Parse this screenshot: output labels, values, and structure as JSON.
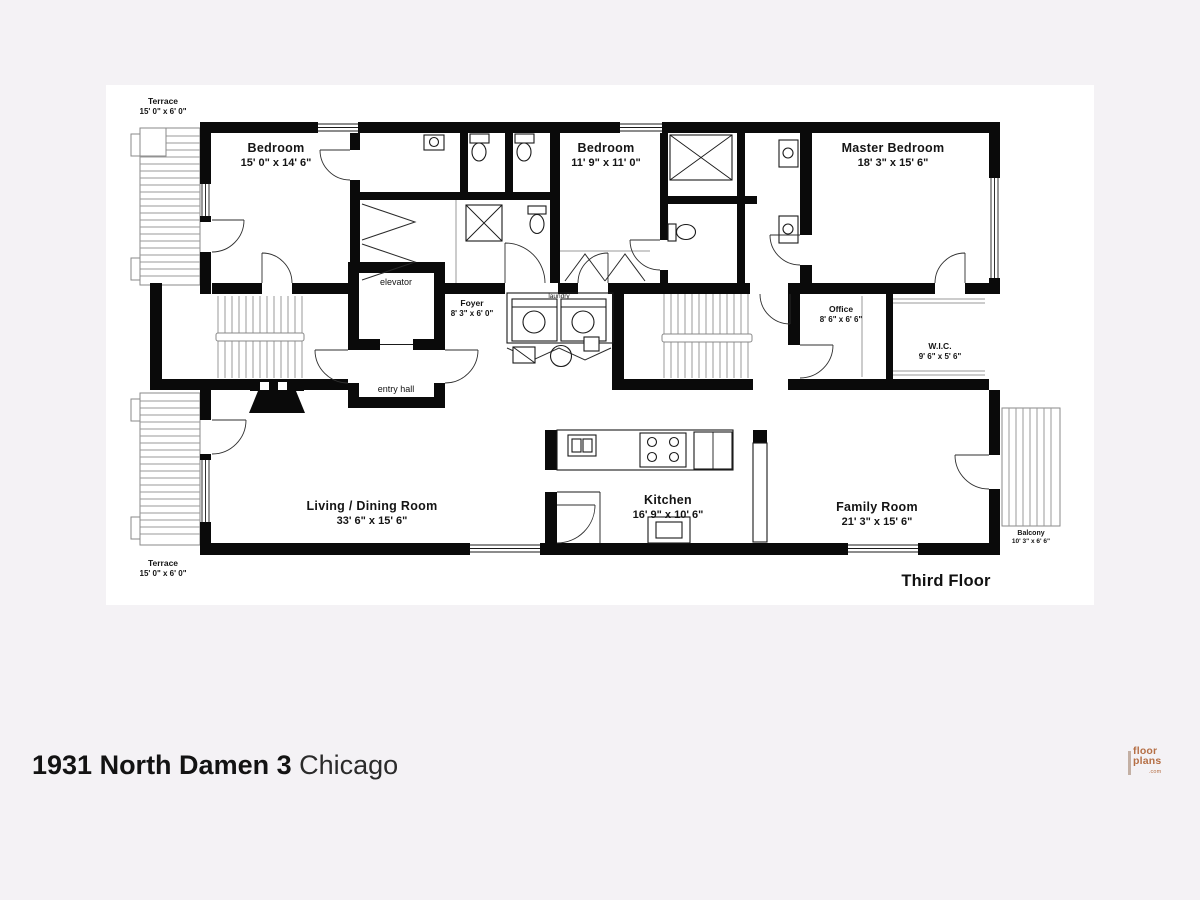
{
  "colors": {
    "wall": "#0a0a0a",
    "line-gray": "#999999",
    "bg": "#f4f2f5",
    "sheet": "#ffffff",
    "logo-orange": "#b56f45",
    "text": "#1b1b1b"
  },
  "plan": {
    "floor_label": "Third Floor",
    "rooms": {
      "terrace_top": {
        "name": "Terrace",
        "dims": "15' 0\" x 6' 0\""
      },
      "bedroom_left": {
        "name": "Bedroom",
        "dims": "15' 0\" x 14' 6\""
      },
      "bedroom_mid": {
        "name": "Bedroom",
        "dims": "11' 9\" x 11' 0\""
      },
      "master_bedroom": {
        "name": "Master Bedroom",
        "dims": "18' 3\" x 15' 6\""
      },
      "elevator": {
        "name": "elevator"
      },
      "entry_hall": {
        "name": "entry hall"
      },
      "foyer": {
        "name": "Foyer",
        "dims": "8' 3\" x 6' 0\""
      },
      "laundry": {
        "name": "laundry"
      },
      "office": {
        "name": "Office",
        "dims": "8' 6\" x 6' 6\""
      },
      "wic": {
        "name": "W.I.C.",
        "dims": "9' 6\" x 5' 6\""
      },
      "living_dining": {
        "name": "Living / Dining Room",
        "dims": "33' 6\" x 15' 6\""
      },
      "kitchen": {
        "name": "Kitchen",
        "dims": "16' 9\" x 10' 6\""
      },
      "family_room": {
        "name": "Family Room",
        "dims": "21' 3\" x 15' 6\""
      },
      "balcony": {
        "name": "Balcony",
        "dims": "10' 3\" x 6' 6\""
      },
      "terrace_bottom": {
        "name": "Terrace",
        "dims": "15' 0\" x 6' 0\""
      }
    }
  },
  "footer": {
    "address": "1931 North Damen 3",
    "city": "Chicago"
  },
  "logo": {
    "word1": "floor",
    "word2": "plans",
    "suffix": ".com"
  }
}
